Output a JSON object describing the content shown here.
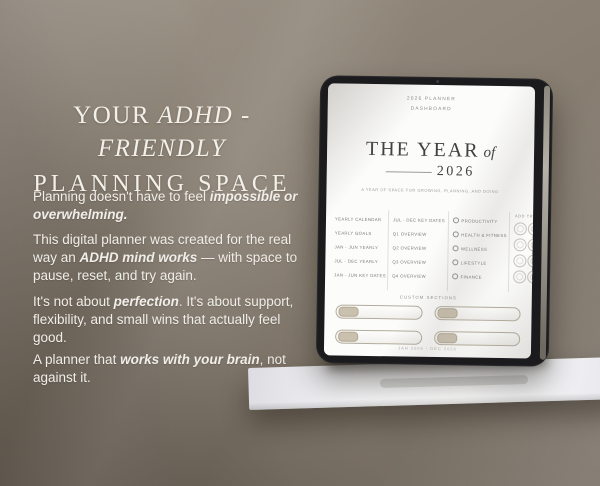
{
  "colors": {
    "wall": "#867c70",
    "shelf": "#ebebef",
    "tablet_bezel": "#1b1b1e",
    "screen": "#fcfcfb",
    "accent_beige": "#cac0ae",
    "heading_text": "#f3f0e9"
  },
  "left_panel": {
    "heading": {
      "line1_segments": [
        {
          "t": "YOUR ",
          "e": false
        },
        {
          "t": "ADHD - FRIENDLY",
          "e": true
        }
      ],
      "line2": "PLANNING SPACE"
    },
    "paragraphs": [
      [
        {
          "t": "Planning doesn't have to feel ",
          "e": false
        },
        {
          "t": "impossible or overwhelming.",
          "e": true
        }
      ],
      [
        {
          "t": "This digital planner was created for the real way an ",
          "e": false
        },
        {
          "t": "ADHD mind works",
          "e": true
        },
        {
          "t": " — with space to pause, reset, and try again.",
          "e": false
        }
      ],
      [
        {
          "t": "It's not about ",
          "e": false
        },
        {
          "t": "perfection",
          "e": true
        },
        {
          "t": ". It's about support, flexibility, and small wins that actually feel good.",
          "e": false
        }
      ],
      [
        {
          "t": "A planner that ",
          "e": false
        },
        {
          "t": "works with your brain",
          "e": true
        },
        {
          "t": ", not against it.",
          "e": false
        }
      ]
    ]
  },
  "tablet": {
    "screen": {
      "header": {
        "line1": "2026 PLANNER",
        "line2": "DASHBOARD"
      },
      "title": {
        "main": "THE YEAR",
        "of": "of",
        "year": "2026"
      },
      "tagline": "A YEAR OF SPACE FOR GROWING, PLANNING, AND DOING",
      "nav_columns": [
        {
          "items": [
            "YEARLY CALENDAR",
            "YEARLY GOALS",
            "JAN - JUN YEARLY",
            "JUL - DEC YEARLY",
            "JAN - JUN KEY DATES"
          ]
        },
        {
          "items": [
            "JUL - DEC KEY DATES",
            "Q1 OVERVIEW",
            "Q2 OVERVIEW",
            "Q3 OVERVIEW",
            "Q4 OVERVIEW"
          ]
        }
      ],
      "categories": [
        {
          "icon": "productivity-icon",
          "label": "PRODUCTIVITY"
        },
        {
          "icon": "health-fitness-icon",
          "label": "HEALTH & FITNESS"
        },
        {
          "icon": "wellness-icon",
          "label": "WELLNESS"
        },
        {
          "icon": "lifestyle-icon",
          "label": "LIFESTYLE"
        },
        {
          "icon": "finance-icon",
          "label": "FINANCE"
        }
      ],
      "trackers": {
        "header": "ADD TRACKERS",
        "rows": 4,
        "cols": 3
      },
      "custom_sections": {
        "header": "CUSTOM SECTIONS",
        "count": 4
      },
      "footer": "JAN 2026 - DEC 2026"
    }
  }
}
